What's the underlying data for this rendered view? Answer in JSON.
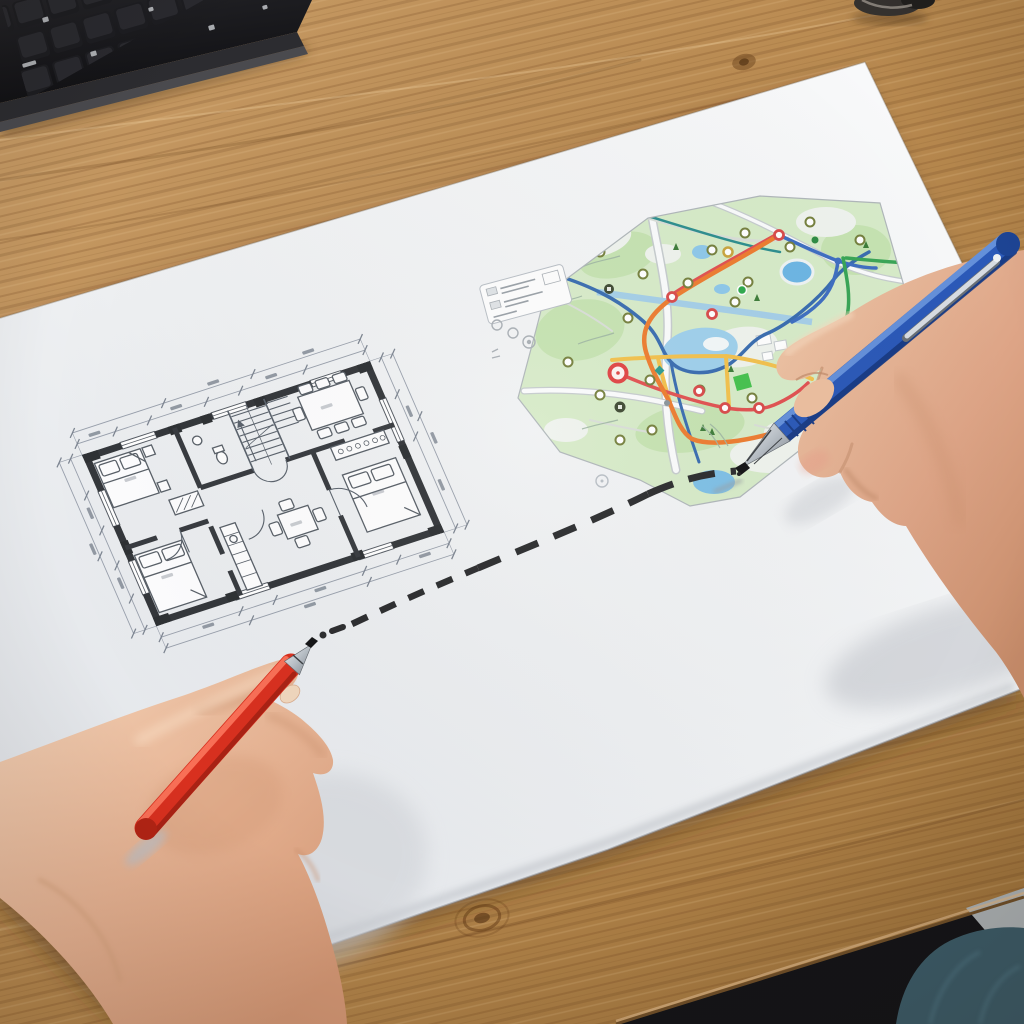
{
  "scene": {
    "description": "Overhead photograph of a light oak desk. A large white sheet holds an architectural floor plan on the left and a colorful street map on the right. A left hand holding a red pen and a right hand holding a blue ballpoint pen are linked by a hand-drawn black dashed line running from the floor plan to the map. A black keyboard corner sits at the top-left, a small metal object at the top edge, and the desk edge, gray floor and a denim knee appear at the bottom-right.",
    "objects": [
      "wooden-desk",
      "black-keyboard",
      "metal-object",
      "paper-sheet",
      "floor-plan-drawing",
      "city-map-drawing",
      "map-legend",
      "dashed-connector-line",
      "left-hand",
      "red-pen",
      "right-hand",
      "blue-pen",
      "desk-front-edge",
      "room-floor",
      "denim-knee"
    ]
  },
  "palette": {
    "wood": "#b9894f",
    "wood_dark": "#9a7038",
    "wood_light": "#cfa672",
    "paper": "#eff1f4",
    "paper_shadow": "#d6d9de",
    "keyboard_black": "#1b1b1e",
    "plan_wall": "#34373b",
    "plan_line": "#5a626c",
    "dimension_line": "#8b93a0",
    "map_green": "#d7ebc9",
    "map_green_dark": "#c6e3b2",
    "map_water": "#9fd0ec",
    "route_orange": "#ed7d31",
    "route_red": "#e15252",
    "route_yellow": "#f2c14e",
    "route_green": "#3aa557",
    "route_blue": "#3f6fc1",
    "river": "#3a6db0",
    "canal": "#a5cfe8",
    "marker_ring": "#76813f",
    "dash_line": "#2c2d2f",
    "red_pen": "#e03428",
    "blue_pen": "#2b59b8",
    "skin_light": "#f2cdb2",
    "skin_mid": "#e2ab8b",
    "denim": "#3c5a66",
    "floor_gray": "#a9aeb0"
  },
  "floor_plan": {
    "type": "architectural-drawing",
    "rooms": [
      "bedroom-top-left",
      "bedroom-bottom-left",
      "living-dining-top-right",
      "bedroom-bottom-right",
      "kitchen-center",
      "bathroom",
      "staircase",
      "hallway"
    ],
    "furniture": [
      "double-bed",
      "double-bed",
      "double-bed",
      "dining-table-with-6-chairs",
      "small-table-with-4-chairs",
      "wardrobes-with-hangers",
      "kitchen-counter",
      "l-shaped-stairs",
      "door-swing-arcs"
    ],
    "annotations": "two tiers of dimension lines with tick marks on all four sides; figures too small to be readable"
  },
  "map": {
    "type": "street-map-drawing",
    "features": [
      "green park areas",
      "blue ponds",
      "dark blue river",
      "light blue canal",
      "white roads with gray casing",
      "orange route",
      "red route with circular stop nodes",
      "yellow route",
      "green route",
      "blue route",
      "red pin marker",
      "point-of-interest ring markers",
      "tiny tree symbols",
      "legend box with unreadable rows"
    ],
    "marker_count": 28,
    "legend": "small white rounded box at the map's left with two unreadable symbol rows and loose circles beneath"
  },
  "annotation": {
    "dashed_line": "hand-drawn black dashed curve connecting the floor plan (red pen tip) to the map (blue pen tip)"
  }
}
